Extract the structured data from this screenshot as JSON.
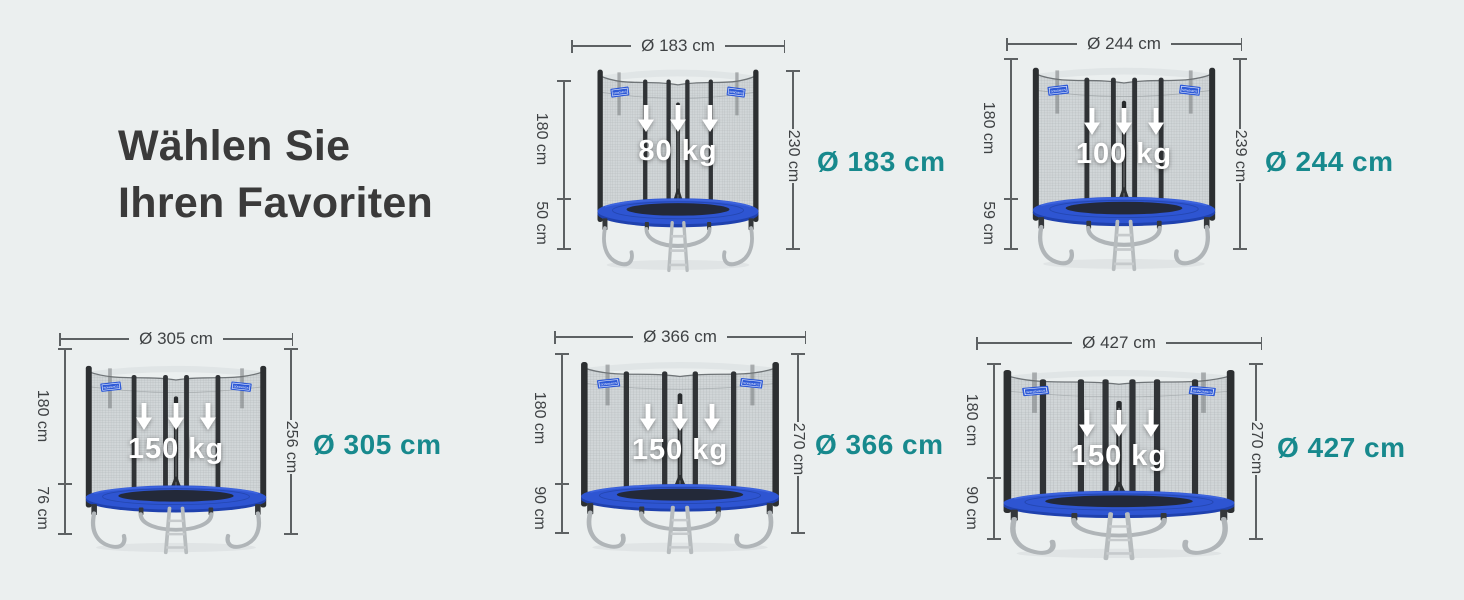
{
  "heading": {
    "line1": "Wählen Sie",
    "line2": "Ihren Favoriten"
  },
  "colors": {
    "background": "#ebefef",
    "heading_text": "#3a3a3a",
    "accent_teal": "#17898d",
    "dimension_line": "#5d6163",
    "dimension_text": "#3f4244",
    "pad_blue": "#2e55d2",
    "pad_blue_dark": "#1f41ae",
    "tag_blue": "#2d59d6",
    "net_gray": "#cfd4d6",
    "pole_dark": "#2c2f31",
    "load_text": "#ffffff"
  },
  "trampolines": [
    {
      "diameter_dim": "Ø 183 cm",
      "net_height": "180 cm",
      "frame_height": "50 cm",
      "total_height": "230 cm",
      "max_load": "80 kg",
      "size_label": "Ø 183 cm",
      "brand_tag": "SONGMICS"
    },
    {
      "diameter_dim": "Ø 244 cm",
      "net_height": "180 cm",
      "frame_height": "59 cm",
      "total_height": "239 cm",
      "max_load": "100 kg",
      "size_label": "Ø 244 cm",
      "brand_tag": "SONGMICS"
    },
    {
      "diameter_dim": "Ø 305 cm",
      "net_height": "180 cm",
      "frame_height": "76 cm",
      "total_height": "256 cm",
      "max_load": "150 kg",
      "size_label": "Ø 305 cm",
      "brand_tag": "SONGMICS"
    },
    {
      "diameter_dim": "Ø 366 cm",
      "net_height": "180 cm",
      "frame_height": "90 cm",
      "total_height": "270 cm",
      "max_load": "150 kg",
      "size_label": "Ø 366 cm",
      "brand_tag": "SONGMICS"
    },
    {
      "diameter_dim": "Ø 427 cm",
      "net_height": "180 cm",
      "frame_height": "90 cm",
      "total_height": "270 cm",
      "max_load": "150 kg",
      "size_label": "Ø 427 cm",
      "brand_tag": "SONGMICS"
    }
  ]
}
